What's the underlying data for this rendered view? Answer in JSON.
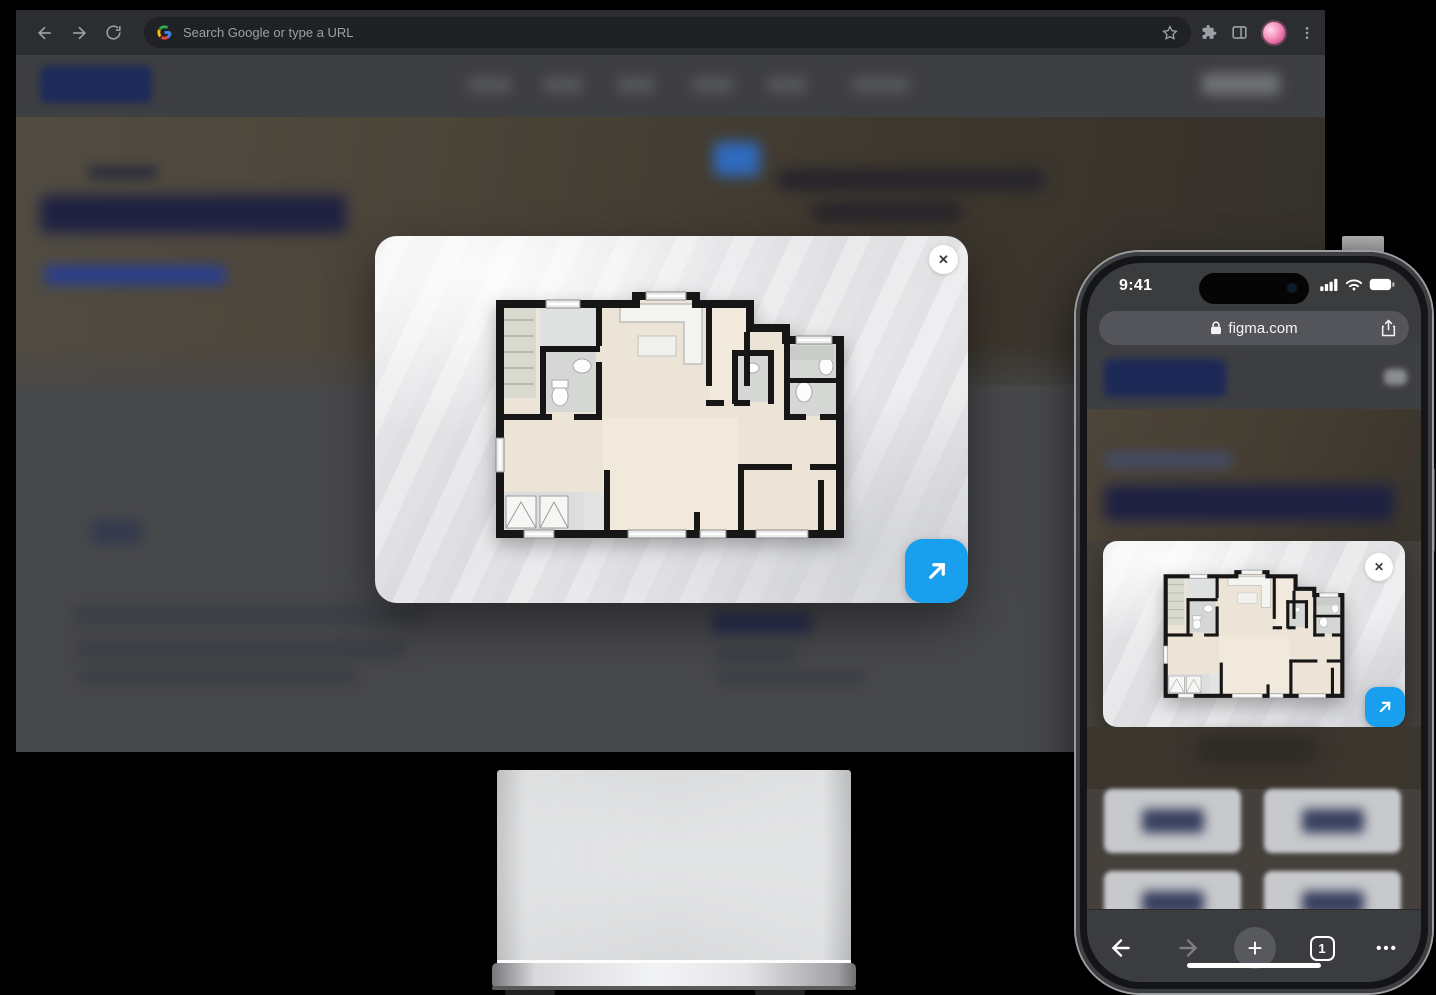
{
  "desktop_browser": {
    "address_bar": {
      "placeholder": "Search Google or type a URL"
    },
    "nav_icons": [
      "back-arrow",
      "forward-arrow",
      "reload"
    ],
    "right_icons": [
      "bookmark-star",
      "extensions-puzzle",
      "side-panel",
      "profile-avatar",
      "menu-dots"
    ]
  },
  "floorplan_modal": {
    "close_glyph": "✕",
    "expand_glyph": "↗"
  },
  "phone": {
    "status_bar": {
      "time": "9:41",
      "icons": [
        "signal",
        "wifi",
        "battery"
      ]
    },
    "address_bar": {
      "url": "figma.com",
      "lock_icon": "lock",
      "share_icon": "share"
    },
    "floorplan_card": {
      "close_glyph": "✕",
      "expand_glyph": "↗"
    },
    "toolbar": {
      "new_tab_glyph": "+",
      "tab_count": "1",
      "menu_glyph": "•••"
    }
  },
  "colors": {
    "accent_blue": "#18a0ee",
    "chrome_toolbar": "#2c2d30",
    "omnibox": "#202124",
    "page_gray": "#47484a",
    "phone_toolbar": "#3b3c3f"
  }
}
